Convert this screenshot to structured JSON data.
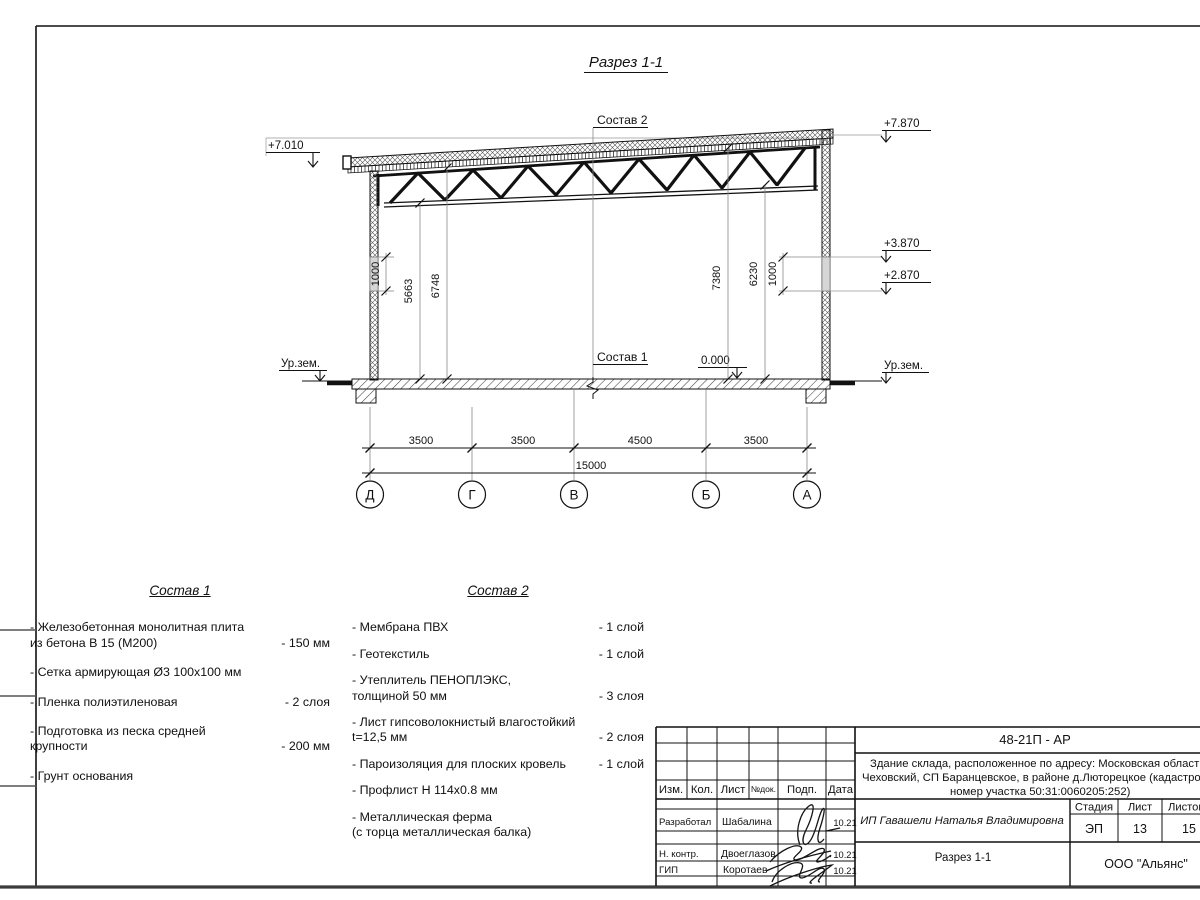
{
  "sheet": {
    "title": "Разрез 1-1",
    "section_label_top": "Состав 2",
    "section_label_floor": "Состав 1"
  },
  "elevations": {
    "left_top": "+7.010",
    "right_top": "+7.870",
    "right_mid1": "+3.870",
    "right_mid2": "+2.870",
    "zero": "0.000",
    "ground_left": "Ур.зем.",
    "ground_right": "Ур.зем."
  },
  "dims": {
    "vertical": {
      "left_window": "1000",
      "left_truss": "5663",
      "left_roof": "6748",
      "right_roof": "7380",
      "right_truss": "6230",
      "right_window": "1000"
    },
    "spans": [
      "3500",
      "3500",
      "4500",
      "3500"
    ],
    "total": "15000",
    "axes": [
      "Д",
      "Г",
      "В",
      "Б",
      "А"
    ]
  },
  "sostav1": {
    "title": "Состав 1",
    "items": [
      {
        "name": "- Железобетонная  монолитная плита\nиз бетона В 15 (М200)",
        "value": "- 150 мм"
      },
      {
        "name": "- Сетка армирующая Ø3 100х100 мм",
        "value": ""
      },
      {
        "name": "- Пленка полиэтиленовая",
        "value": "-  2 слоя"
      },
      {
        "name": "- Подготовка из песка средней\nкрупности",
        "value": "- 200 мм"
      },
      {
        "name": "- Грунт основания",
        "value": ""
      }
    ]
  },
  "sostav2": {
    "title": "Состав 2",
    "items": [
      {
        "name": "- Мембрана ПВХ",
        "value": "- 1 слой"
      },
      {
        "name": "- Геотекстиль",
        "value": "- 1 слой"
      },
      {
        "name": "- Утеплитель ПЕНОПЛЭКС,\nтолщиной 50 мм",
        "value": "- 3 слоя"
      },
      {
        "name": "- Лист гипсоволокнистый влагостойкий\nt=12,5 мм",
        "value": "- 2 слоя"
      },
      {
        "name": "- Пароизоляция для плоских кровель",
        "value": "- 1 слой"
      },
      {
        "name": "- Профлист Н 114х0.8 мм",
        "value": ""
      },
      {
        "name": "- Металлическая ферма\n(с торца металлическая балка)",
        "value": ""
      }
    ]
  },
  "titleblock": {
    "code": "48-21П - АР",
    "desc_line1": "Здание склада, расположенное по адресу: Московская область, р",
    "desc_line2": "Чеховский, СП Баранцевское, в районе д.Люторецкое  (кадастровы",
    "desc_line3": "номер участка 50:31:0060205:252)",
    "customer": "ИП Гавашели Наталья Владимировна",
    "doc_title": "Разрез 1-1",
    "company": "ООО \"Альянс\"",
    "stage_label": "Стадия",
    "sheet_label": "Лист",
    "sheets_label": "Листов",
    "stage": "ЭП",
    "sheet_num": "13",
    "sheets_total": "15",
    "cols": {
      "izm": "Изм.",
      "kol": "Кол.",
      "list": "Лист",
      "ndoc": "№док.",
      "podp": "Подп.",
      "data": "Дата"
    },
    "rows": [
      {
        "role": "Разработал",
        "name": "Шабалина",
        "date": "10.21"
      },
      {
        "role": "Н. контр.",
        "name": "Двоеглазов",
        "date": "10.21"
      },
      {
        "role": "ГИП",
        "name": "Коротаев",
        "date": "10.21"
      }
    ]
  }
}
